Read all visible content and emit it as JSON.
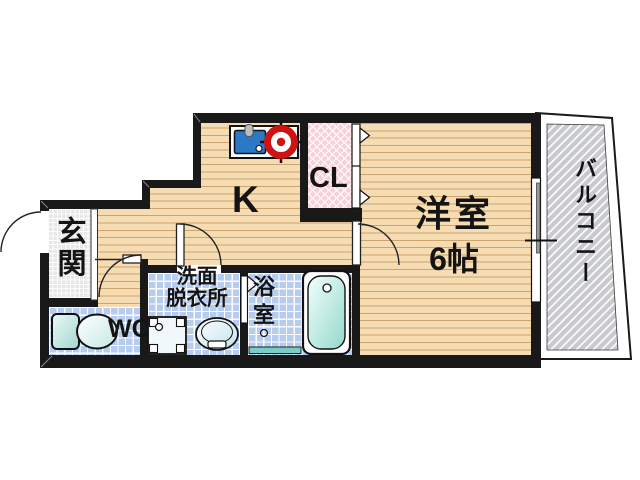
{
  "plan_title": "apartment-floor-plan",
  "rooms": {
    "genkan": {
      "label": "玄関"
    },
    "wc": {
      "label": "WC"
    },
    "washroom": {
      "label1": "洗面",
      "label2": "脱衣所"
    },
    "bathroom": {
      "label": "浴室"
    },
    "kitchen": {
      "label": "K"
    },
    "closet": {
      "label": "CL"
    },
    "western_room": {
      "label": "洋室",
      "size": "6帖"
    },
    "balcony": {
      "label": "バルコニー"
    }
  },
  "fixtures": [
    "kitchen-sink-icon",
    "gas-stove-icon",
    "toilet-icon",
    "washing-machine-icon",
    "wash-basin-icon",
    "bathtub-icon",
    "door-swing-icon",
    "folding-door-icon",
    "sliding-window-icon",
    "drain-icon"
  ],
  "colors": {
    "wall": "#191919",
    "wood_floor": "#f6dcb2",
    "wood_line": "#c79e67",
    "wet_area_tile": "#b7cdf0",
    "genkan_tile": "#e7e7e7",
    "closet_pink": "#f8d0d8",
    "balcony_gray": "#c9cace",
    "sink_blue": "#2b78c5",
    "stove_red": "#cc1414",
    "tub_teal": "#93d8cc",
    "threshold_teal": "#77cec4"
  }
}
